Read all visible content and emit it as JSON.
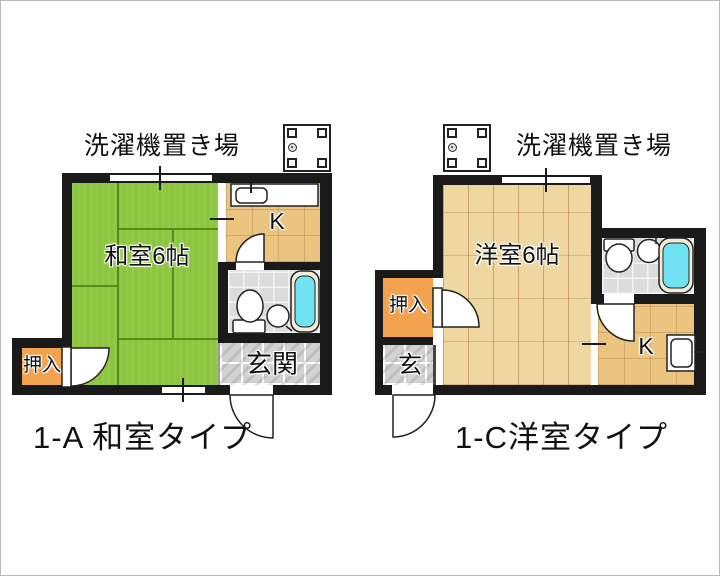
{
  "colors": {
    "tatami": "#8cc63e",
    "wood": "#eed7a1",
    "kitchen": "#ebc57f",
    "closet": "#f2a24e",
    "tub": "#6fe3f2",
    "tile": "#d2d2d2",
    "wall": "#1a1a1a"
  },
  "plan_a": {
    "title": "1-A 和室タイプ",
    "laundry_label": "洗濯機置き場",
    "room_label": "和室6帖",
    "kitchen_label": "K",
    "entrance_label": "玄関",
    "closet_label": "押入"
  },
  "plan_c": {
    "title": "1-C洋室タイプ",
    "laundry_label": "洗濯機置き場",
    "room_label": "洋室6帖",
    "kitchen_label": "K",
    "entrance_label": "玄",
    "closet_label": "押入"
  }
}
